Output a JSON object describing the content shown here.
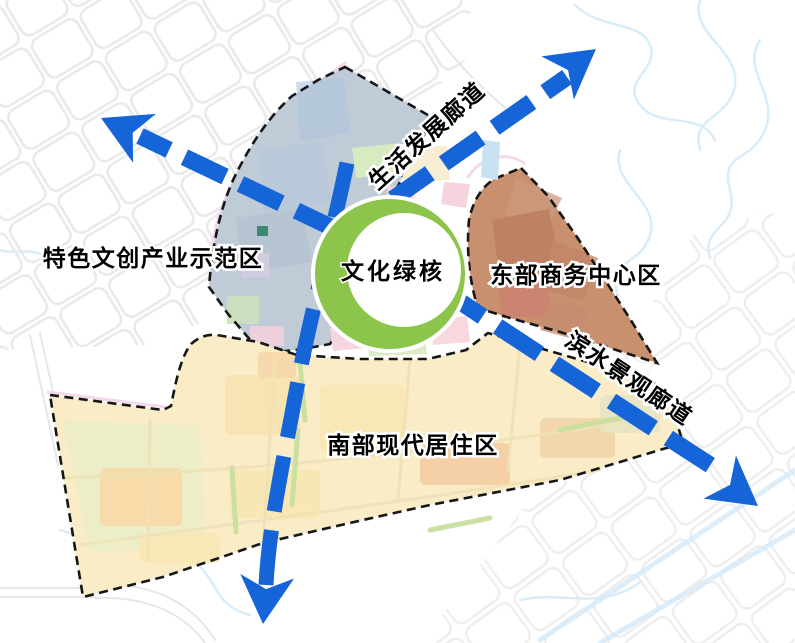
{
  "diagram": {
    "core": {
      "label": "文化绿核"
    },
    "regions": {
      "west": {
        "label": "特色文创产业示范区",
        "fill": "#BFCBD7"
      },
      "east": {
        "label": "东部商务中心区",
        "fill": "#C8906F"
      },
      "south": {
        "label": "南部现代居住区",
        "fill": "#F9ECC6"
      }
    },
    "corridors": {
      "life": {
        "label": "生活发展廊道"
      },
      "waterfront": {
        "label": "滨水景观廊道"
      }
    },
    "colors": {
      "arrow": "#1565D8",
      "ring_green": "#8CC44C",
      "border_dash": "#161616",
      "river": "#D9ECF9",
      "grid_road": "#E7E7E7"
    }
  }
}
